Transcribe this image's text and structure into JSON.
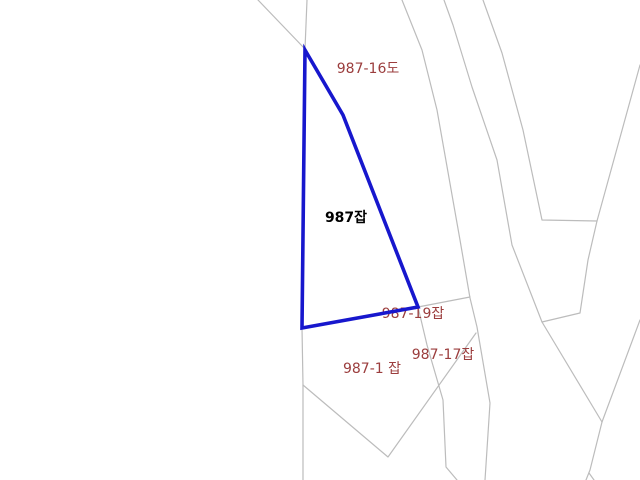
{
  "map": {
    "background_color": "#ffffff",
    "boundary_line_color": "#bcbcbc",
    "boundary_line_width": 1.2,
    "highlight_parcel": {
      "name": "987잡",
      "stroke_color": "#1717cd",
      "stroke_width": 3.6,
      "points": [
        [
          305,
          50
        ],
        [
          343,
          115
        ],
        [
          418,
          307
        ],
        [
          302,
          328
        ]
      ]
    },
    "labels": [
      {
        "text": "987-16도",
        "x": 368,
        "y": 73,
        "color": "#9b3d3d",
        "bold": false
      },
      {
        "text": "987잡",
        "x": 346,
        "y": 222,
        "color": "#000000",
        "bold": true
      },
      {
        "text": "987-19잡",
        "x": 413,
        "y": 318,
        "color": "#9b3d3d",
        "bold": false
      },
      {
        "text": "987-17잡",
        "x": 443,
        "y": 359,
        "color": "#9b3d3d",
        "bold": false
      },
      {
        "text": "987-1 잡",
        "x": 372,
        "y": 373,
        "color": "#9b3d3d",
        "bold": false
      }
    ],
    "boundary_lines": [
      [
        [
          258,
          0
        ],
        [
          305,
          49
        ]
      ],
      [
        [
          307,
          0
        ],
        [
          305,
          49
        ]
      ],
      [
        [
          302,
          328
        ],
        [
          303,
          385
        ],
        [
          303,
          480
        ]
      ],
      [
        [
          303,
          385
        ],
        [
          388,
          457
        ],
        [
          476,
          333
        ]
      ],
      [
        [
          418,
          307
        ],
        [
          427,
          345
        ],
        [
          443,
          400
        ],
        [
          446,
          467
        ],
        [
          457,
          480
        ]
      ],
      [
        [
          418,
          307
        ],
        [
          470,
          297
        ]
      ],
      [
        [
          402,
          0
        ],
        [
          422,
          50
        ],
        [
          437,
          110
        ],
        [
          460,
          240
        ],
        [
          470,
          298
        ],
        [
          477,
          327
        ],
        [
          490,
          403
        ],
        [
          485,
          480
        ]
      ],
      [
        [
          444,
          0
        ],
        [
          453,
          25
        ],
        [
          472,
          87
        ],
        [
          497,
          160
        ],
        [
          512,
          245
        ],
        [
          542,
          322
        ],
        [
          602,
          422
        ]
      ],
      [
        [
          483,
          0
        ],
        [
          502,
          53
        ],
        [
          523,
          130
        ],
        [
          542,
          220
        ],
        [
          597,
          221
        ]
      ],
      [
        [
          597,
          221
        ],
        [
          640,
          65
        ]
      ],
      [
        [
          597,
          221
        ],
        [
          588,
          260
        ],
        [
          580,
          313
        ],
        [
          542,
          322
        ]
      ],
      [
        [
          640,
          320
        ],
        [
          602,
          422
        ]
      ],
      [
        [
          602,
          422
        ],
        [
          590,
          470
        ],
        [
          586,
          480
        ]
      ],
      [
        [
          589,
          473
        ],
        [
          594,
          480
        ]
      ]
    ]
  }
}
